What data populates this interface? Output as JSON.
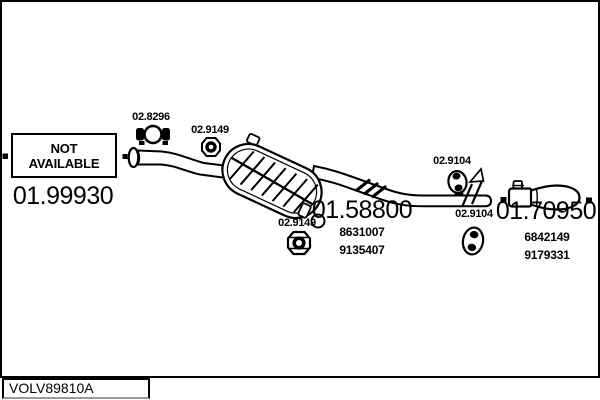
{
  "colors": {
    "ink": "#000000",
    "paper": "#ffffff"
  },
  "footer": {
    "code": "VOLV89810A"
  },
  "parts": {
    "front_pipe": {
      "code": "01.99930",
      "availability_lines": [
        "NOT",
        "AVAILABLE"
      ]
    },
    "clamp": {
      "code": "02.8296"
    },
    "hanger_front": {
      "code": "02.9149"
    },
    "hanger_mid": {
      "code": "02.9149"
    },
    "mid_muffler": {
      "code": "01.58800",
      "oem_numbers": [
        "8631007",
        "9135407"
      ]
    },
    "hanger_rear_upper": {
      "code": "02.9104"
    },
    "hanger_rear_lower": {
      "code": "02.9104"
    },
    "rear_muffler": {
      "code": "01.70950",
      "oem_numbers": [
        "6842149",
        "9179331"
      ]
    }
  }
}
